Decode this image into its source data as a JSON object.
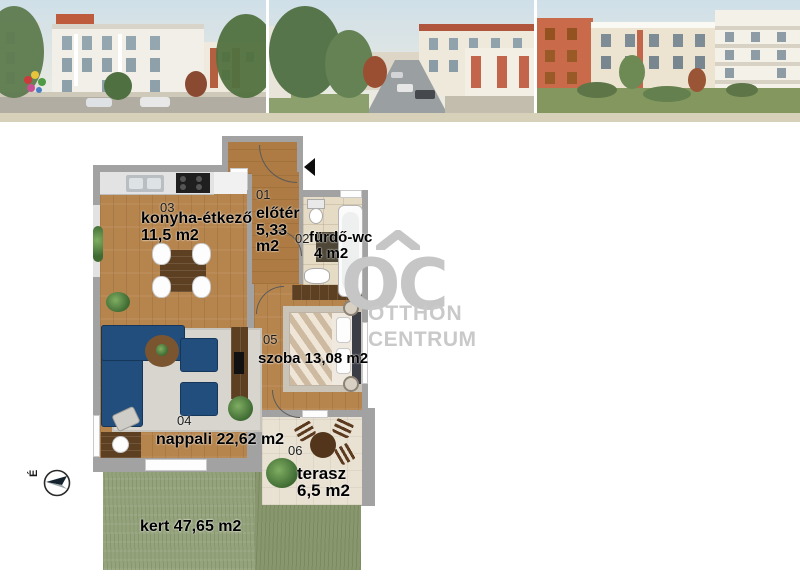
{
  "plan": {
    "rooms": {
      "eloter": {
        "number": "01",
        "name": "előtér",
        "area1": "5,33",
        "area2": "m2"
      },
      "furdo": {
        "number": "02",
        "name": "fürdő-wc",
        "area": "4 m2"
      },
      "konyha": {
        "number": "03",
        "name": "konyha-étkező",
        "area": "11,5 m2"
      },
      "nappali": {
        "number": "04",
        "name": "nappali 22,62 m2"
      },
      "szoba": {
        "number": "05",
        "name": "szoba 13,08 m2"
      },
      "terasz": {
        "number": "06",
        "name": "terasz",
        "area": "6,5 m2"
      }
    },
    "kert_label": "kert 47,65 m2",
    "compass": {
      "letter": "É"
    }
  },
  "watermark": {
    "monogram": "OC",
    "line1": "OTTHON",
    "line2": "CENTRUM"
  },
  "colors": {
    "wall": "#a2a2a2",
    "wood": "#b6854e",
    "grass": "#95a37c",
    "sofa": "#224e7e",
    "watermark_gray": "#c6c6c6",
    "strip_border": "#d8d1ba"
  }
}
